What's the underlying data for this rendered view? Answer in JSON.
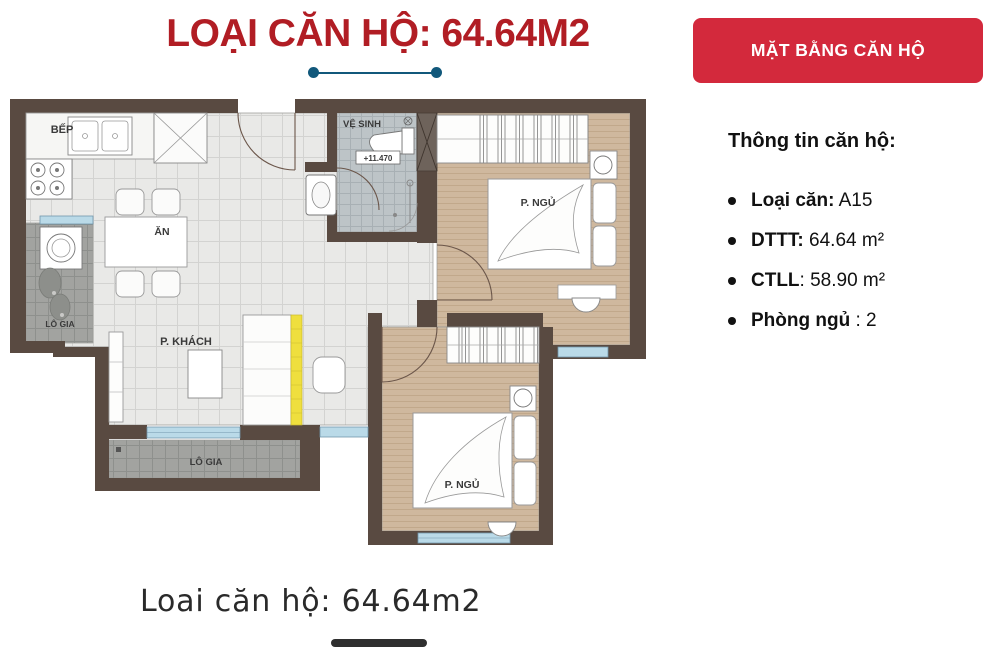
{
  "header": {
    "title": "LOẠI CĂN HỘ: 64.64M2"
  },
  "button": {
    "label": "MẶT BẰNG CĂN HỘ"
  },
  "info": {
    "heading": "Thông tin căn hộ:",
    "items": [
      {
        "bold": "Loại căn:",
        "rest": " A15"
      },
      {
        "bold": "DTTT:",
        "rest": " 64.64 m²"
      },
      {
        "bold": "CTLL",
        "rest": ": 58.90 m²"
      },
      {
        "bold": "Phòng ngủ",
        "rest": " : 2"
      }
    ]
  },
  "plan": {
    "labels": {
      "kitchen": "BẾP",
      "dining": "ĂN",
      "bathroom": "VỆ SINH",
      "level": "+11.470",
      "bedroom1": "P. NGỦ",
      "bedroom2": "P. NGỦ",
      "living": "P. KHÁCH",
      "loggia_left": "LÔ GIA",
      "loggia_bottom": "LÔ GIA"
    }
  },
  "caption": {
    "text": "Loai căn hộ: 64.64m2"
  },
  "colors": {
    "title_red": "#b11d24",
    "button_red": "#d3293c",
    "divider_teal": "#11587b",
    "wall_brown": "#594a41",
    "wood_floor": "#cfb89e",
    "tile_gray": "#a2a3a0",
    "window_blue": "#badae8",
    "sofa_yellow": "#efdf3e"
  }
}
